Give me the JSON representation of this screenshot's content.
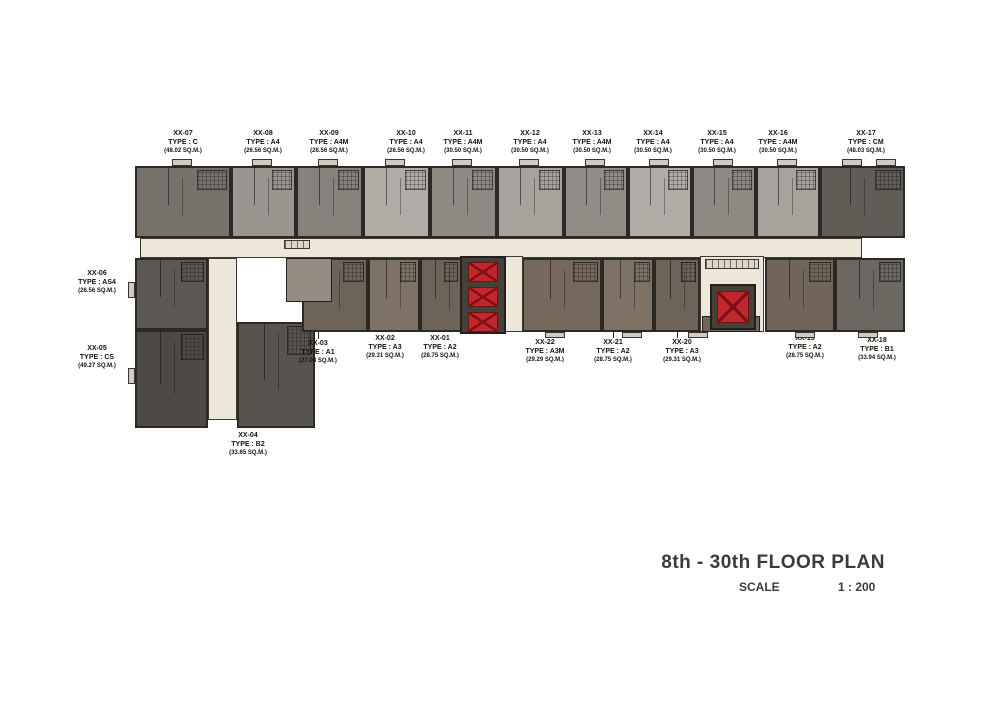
{
  "title": {
    "main": "8th - 30th FLOOR PLAN",
    "scale_label": "SCALE",
    "scale_value": "1 : 200"
  },
  "palette": {
    "corridor": "#ece7d8",
    "wall": "#2c2823",
    "elevator_red": "#c1272d",
    "title_text": "#3b3b3b"
  },
  "units": [
    {
      "id": "XX-07",
      "type_label": "TYPE : C",
      "area_label": "(48.02 SQ.M.)",
      "block": {
        "x": 135,
        "y": 166,
        "w": 96,
        "h": 72
      },
      "color": "#76726b",
      "label": {
        "x": 183,
        "y": 130
      }
    },
    {
      "id": "XX-08",
      "type_label": "TYPE : A4",
      "area_label": "(26.56 SQ.M.)",
      "block": {
        "x": 231,
        "y": 166,
        "w": 65,
        "h": 72
      },
      "color": "#9a968f",
      "label": {
        "x": 263,
        "y": 130
      }
    },
    {
      "id": "XX-09",
      "type_label": "TYPE : A4M",
      "area_label": "(26.56 SQ.M.)",
      "block": {
        "x": 296,
        "y": 166,
        "w": 67,
        "h": 72
      },
      "color": "#86827b",
      "label": {
        "x": 329,
        "y": 130
      }
    },
    {
      "id": "XX-10",
      "type_label": "TYPE : A4",
      "area_label": "(26.56 SQ.M.)",
      "block": {
        "x": 363,
        "y": 166,
        "w": 67,
        "h": 72
      },
      "color": "#b1ada6",
      "label": {
        "x": 406,
        "y": 130
      }
    },
    {
      "id": "XX-11",
      "type_label": "TYPE : A4M",
      "area_label": "(30.50 SQ.M.)",
      "block": {
        "x": 430,
        "y": 166,
        "w": 67,
        "h": 72
      },
      "color": "#8e8a83",
      "label": {
        "x": 463,
        "y": 130
      }
    },
    {
      "id": "XX-12",
      "type_label": "TYPE : A4",
      "area_label": "(30.50 SQ.M.)",
      "block": {
        "x": 497,
        "y": 166,
        "w": 67,
        "h": 72
      },
      "color": "#a7a39c",
      "label": {
        "x": 530,
        "y": 130
      }
    },
    {
      "id": "XX-13",
      "type_label": "TYPE : A4M",
      "area_label": "(30.50 SQ.M.)",
      "block": {
        "x": 564,
        "y": 166,
        "w": 64,
        "h": 72
      },
      "color": "#918d86",
      "label": {
        "x": 592,
        "y": 130
      }
    },
    {
      "id": "XX-14",
      "type_label": "TYPE : A4",
      "area_label": "(30.50 SQ.M.)",
      "block": {
        "x": 628,
        "y": 166,
        "w": 64,
        "h": 72
      },
      "color": "#b1ada6",
      "label": {
        "x": 653,
        "y": 130
      }
    },
    {
      "id": "XX-15",
      "type_label": "TYPE : A4",
      "area_label": "(30.50 SQ.M.)",
      "block": {
        "x": 692,
        "y": 166,
        "w": 64,
        "h": 72
      },
      "color": "#8e8a83",
      "label": {
        "x": 717,
        "y": 130
      }
    },
    {
      "id": "XX-16",
      "type_label": "TYPE : A4M",
      "area_label": "(30.50 SQ.M.)",
      "block": {
        "x": 756,
        "y": 166,
        "w": 64,
        "h": 72
      },
      "color": "#a7a39c",
      "label": {
        "x": 778,
        "y": 130
      }
    },
    {
      "id": "XX-17",
      "type_label": "TYPE : CM",
      "area_label": "(48.03 SQ.M.)",
      "block": {
        "x": 820,
        "y": 166,
        "w": 85,
        "h": 72
      },
      "color": "#605c56",
      "label": {
        "x": 866,
        "y": 130
      }
    },
    {
      "id": "XX-06",
      "type_label": "TYPE : AS4",
      "area_label": "(26.56 SQ.M.)",
      "block": {
        "x": 135,
        "y": 258,
        "w": 73,
        "h": 72
      },
      "color": "#5b5752",
      "label": {
        "x": 97,
        "y": 270
      }
    },
    {
      "id": "XX-05",
      "type_label": "TYPE : CS",
      "area_label": "(49.27 SQ.M.)",
      "block": {
        "x": 135,
        "y": 330,
        "w": 73,
        "h": 98
      },
      "color": "#4d4a45",
      "label": {
        "x": 97,
        "y": 345
      }
    },
    {
      "id": "XX-04",
      "type_label": "TYPE : B2",
      "area_label": "(33.65 SQ.M.)",
      "block": {
        "x": 237,
        "y": 322,
        "w": 78,
        "h": 106
      },
      "color": "#57534e",
      "label": {
        "x": 248,
        "y": 432
      }
    },
    {
      "id": "XX-03",
      "type_label": "TYPE : A1",
      "area_label": "(27.08 SQ.M.)",
      "block": {
        "x": 302,
        "y": 258,
        "w": 66,
        "h": 74
      },
      "color": "#6e6358",
      "label": {
        "x": 318,
        "y": 340
      },
      "leader": {
        "x": 318,
        "y1": 332,
        "y2": 339
      }
    },
    {
      "id": "XX-02",
      "type_label": "TYPE : A3",
      "area_label": "(29.31 SQ.M.)",
      "block": {
        "x": 368,
        "y": 258,
        "w": 52,
        "h": 74
      },
      "color": "#7e7266",
      "label": {
        "x": 385,
        "y": 335
      }
    },
    {
      "id": "XX-01",
      "type_label": "TYPE : A2",
      "area_label": "(28.75 SQ.M.)",
      "block": {
        "x": 420,
        "y": 258,
        "w": 42,
        "h": 74
      },
      "color": "#6e6358",
      "label": {
        "x": 440,
        "y": 335
      }
    },
    {
      "id": "XX-22",
      "type_label": "TYPE : A3M",
      "area_label": "(29.29 SQ.M.)",
      "block": {
        "x": 522,
        "y": 258,
        "w": 80,
        "h": 74
      },
      "color": "#76695c",
      "label": {
        "x": 545,
        "y": 339
      },
      "leader": {
        "x": 545,
        "y1": 332,
        "y2": 338
      }
    },
    {
      "id": "XX-21",
      "type_label": "TYPE : A2",
      "area_label": "(28.75 SQ.M.)",
      "block": {
        "x": 602,
        "y": 258,
        "w": 52,
        "h": 74
      },
      "color": "#7e7266",
      "label": {
        "x": 613,
        "y": 339
      },
      "leader": {
        "x": 613,
        "y1": 332,
        "y2": 338
      }
    },
    {
      "id": "XX-20",
      "type_label": "TYPE : A3",
      "area_label": "(29.31 SQ.M.)",
      "block": {
        "x": 654,
        "y": 258,
        "w": 46,
        "h": 74
      },
      "color": "#6e6358",
      "label": {
        "x": 682,
        "y": 339
      },
      "leader": {
        "x": 677,
        "y1": 332,
        "y2": 338
      }
    },
    {
      "id": "XX-19",
      "type_label": "TYPE : A2",
      "area_label": "(28.75 SQ.M.)",
      "block": {
        "x": 765,
        "y": 258,
        "w": 70,
        "h": 74
      },
      "color": "#71655a",
      "label": {
        "x": 805,
        "y": 335
      }
    },
    {
      "id": "XX-18",
      "type_label": "TYPE : B1",
      "area_label": "(33.94 SQ.M.)",
      "block": {
        "x": 835,
        "y": 258,
        "w": 70,
        "h": 74
      },
      "color": "#6b6761",
      "label": {
        "x": 877,
        "y": 337
      }
    }
  ],
  "structures": [
    {
      "name": "corridor-main",
      "kind": "corridor",
      "x": 140,
      "y": 238,
      "w": 722,
      "h": 20
    },
    {
      "name": "corridor-left-wing",
      "kind": "corridor",
      "x": 208,
      "y": 258,
      "w": 29,
      "h": 162
    },
    {
      "name": "lobby-center",
      "kind": "corridor",
      "x": 505,
      "y": 256,
      "w": 18,
      "h": 76
    },
    {
      "name": "lobby-right",
      "kind": "corridor",
      "x": 700,
      "y": 256,
      "w": 64,
      "h": 76
    },
    {
      "name": "stairwell-left",
      "kind": "stair",
      "x": 286,
      "y": 258,
      "w": 46,
      "h": 44,
      "color": "#948c81"
    },
    {
      "name": "stairwell-right",
      "kind": "stair",
      "x": 702,
      "y": 316,
      "w": 58,
      "h": 16,
      "color": "#6b655d"
    },
    {
      "name": "elevator-shaft-center",
      "kind": "shaft",
      "x": 460,
      "y": 256,
      "w": 46,
      "h": 78,
      "color": "#45403a"
    },
    {
      "name": "elevator-car",
      "kind": "car",
      "x": 468,
      "y": 262,
      "w": 30,
      "h": 20
    },
    {
      "name": "elevator-car",
      "kind": "car",
      "x": 468,
      "y": 287,
      "w": 30,
      "h": 20
    },
    {
      "name": "elevator-car",
      "kind": "car",
      "x": 468,
      "y": 312,
      "w": 30,
      "h": 20
    },
    {
      "name": "elevator-shaft-right",
      "kind": "shaft",
      "x": 710,
      "y": 284,
      "w": 46,
      "h": 46,
      "color": "#45403a"
    },
    {
      "name": "elevator-car",
      "kind": "car",
      "x": 717,
      "y": 291,
      "w": 32,
      "h": 32
    },
    {
      "name": "mailboxes-left",
      "kind": "mailbox",
      "x": 284,
      "y": 240,
      "w": 26,
      "h": 9
    },
    {
      "name": "mailboxes-right",
      "kind": "mailbox",
      "x": 705,
      "y": 259,
      "w": 54,
      "h": 10
    },
    {
      "name": "balcony-tab",
      "kind": "tab",
      "x": 172,
      "y": 159,
      "w": 20,
      "h": 7
    },
    {
      "name": "balcony-tab",
      "kind": "tab",
      "x": 252,
      "y": 159,
      "w": 20,
      "h": 7
    },
    {
      "name": "balcony-tab",
      "kind": "tab",
      "x": 318,
      "y": 159,
      "w": 20,
      "h": 7
    },
    {
      "name": "balcony-tab",
      "kind": "tab",
      "x": 385,
      "y": 159,
      "w": 20,
      "h": 7
    },
    {
      "name": "balcony-tab",
      "kind": "tab",
      "x": 452,
      "y": 159,
      "w": 20,
      "h": 7
    },
    {
      "name": "balcony-tab",
      "kind": "tab",
      "x": 519,
      "y": 159,
      "w": 20,
      "h": 7
    },
    {
      "name": "balcony-tab",
      "kind": "tab",
      "x": 585,
      "y": 159,
      "w": 20,
      "h": 7
    },
    {
      "name": "balcony-tab",
      "kind": "tab",
      "x": 649,
      "y": 159,
      "w": 20,
      "h": 7
    },
    {
      "name": "balcony-tab",
      "kind": "tab",
      "x": 713,
      "y": 159,
      "w": 20,
      "h": 7
    },
    {
      "name": "balcony-tab",
      "kind": "tab",
      "x": 777,
      "y": 159,
      "w": 20,
      "h": 7
    },
    {
      "name": "balcony-tab",
      "kind": "tab",
      "x": 842,
      "y": 159,
      "w": 20,
      "h": 7
    },
    {
      "name": "balcony-tab",
      "kind": "tab",
      "x": 876,
      "y": 159,
      "w": 20,
      "h": 7
    },
    {
      "name": "balcony-tab",
      "kind": "tab",
      "x": 545,
      "y": 332,
      "w": 20,
      "h": 6
    },
    {
      "name": "balcony-tab",
      "kind": "tab",
      "x": 622,
      "y": 332,
      "w": 20,
      "h": 6
    },
    {
      "name": "balcony-tab",
      "kind": "tab",
      "x": 688,
      "y": 332,
      "w": 20,
      "h": 6
    },
    {
      "name": "balcony-tab",
      "kind": "tab",
      "x": 795,
      "y": 332,
      "w": 20,
      "h": 6
    },
    {
      "name": "balcony-tab",
      "kind": "tab",
      "x": 858,
      "y": 332,
      "w": 20,
      "h": 6
    },
    {
      "name": "balcony-tab",
      "kind": "tab",
      "x": 128,
      "y": 282,
      "w": 7,
      "h": 16
    },
    {
      "name": "balcony-tab",
      "kind": "tab",
      "x": 128,
      "y": 368,
      "w": 7,
      "h": 16
    }
  ]
}
